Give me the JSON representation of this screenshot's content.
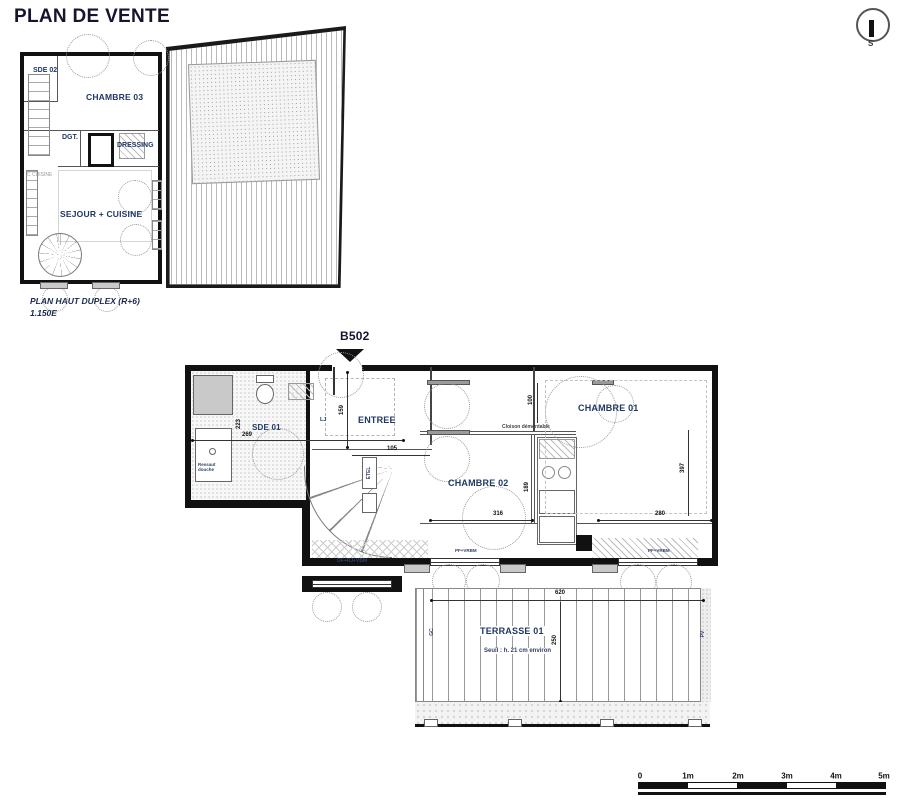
{
  "page": {
    "title": "PLAN DE VENTE"
  },
  "compass": {
    "south": "S"
  },
  "upper_plan": {
    "caption_line1": "PLAN HAUT DUPLEX (R+6)",
    "caption_line2": "1.150E",
    "rooms": {
      "sde02": "SDE 02",
      "chambre03": "CHAMBRE 03",
      "dgt": "DGT.",
      "dressing": "DRESSING",
      "sejour_cuisine": "SEJOUR + CUISINE"
    },
    "annotations": {
      "c_cuisine": "C CUISINE"
    }
  },
  "lower_plan": {
    "unit": "B502",
    "rooms": {
      "entree": "ENTREE",
      "sde01": "SDE 01",
      "chambre01": "CHAMBRE 01",
      "chambre02": "CHAMBRE 02",
      "terrasse": "TERRASSE 01"
    },
    "annotations": {
      "seuil": "Seuil : h. 21 cm environ",
      "ressaut_douche": "Ressaut douche",
      "cloison": "Cloison démontable",
      "etel": "ETEL",
      "lj": "LJ",
      "gc": "GC",
      "pv": "PV",
      "window_left": "OF+RJ+VBM",
      "window_mid": "PF+VRBM",
      "window_right": "PF+VRBM"
    },
    "dims": {
      "d159": "159",
      "d105": "105",
      "d269": "269",
      "d223": "223",
      "d100": "100",
      "d189": "189",
      "d316": "316",
      "d280": "280",
      "d397": "397",
      "d620": "620",
      "d250": "250",
      "d73": "73"
    }
  },
  "scalebar": {
    "labels": [
      "0",
      "1m",
      "2m",
      "3m",
      "4m",
      "5m"
    ]
  },
  "colors": {
    "label": "#1f3864",
    "wall": "#111111"
  }
}
